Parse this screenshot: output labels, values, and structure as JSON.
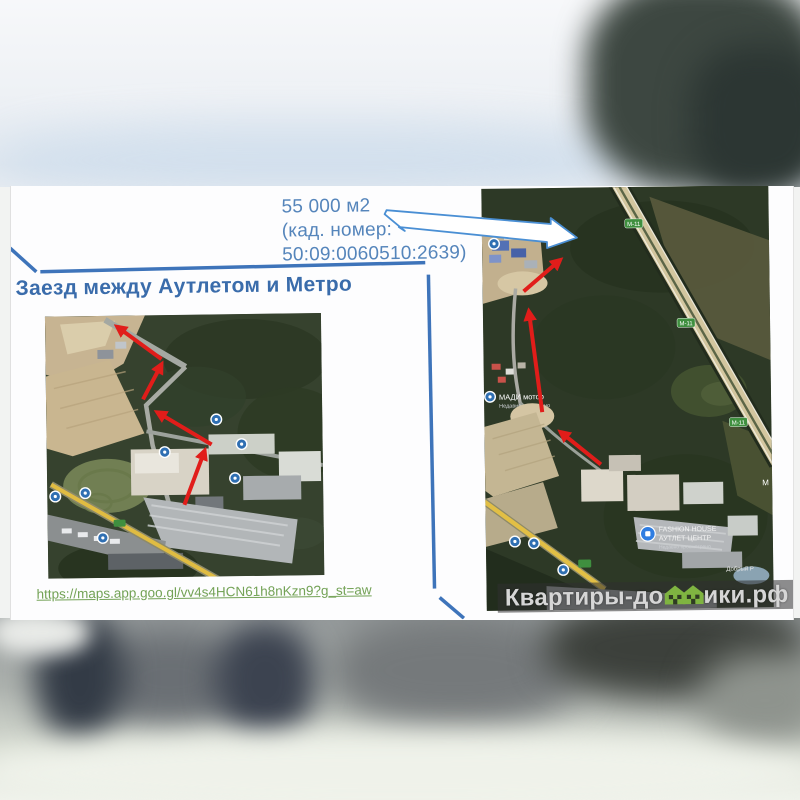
{
  "slide": {
    "annotation": {
      "line1": "55 000 м2",
      "line2": "(кад. номер:",
      "line3": "50:09:0060510:2639)"
    },
    "heading": "Заезд между Аутлетом и Метро",
    "link": "https://maps.app.goo.gl/vv4s4HCN61h8nKzn9?g_st=aw"
  },
  "right_map": {
    "highway_badge": "М-11",
    "madi_label": "МАДИ мотор",
    "madi_sub": "Недавно осмотрено",
    "outlet_line1": "FASHION HOUSE",
    "outlet_line2": "АУТЛЕТ ЦЕНТР",
    "outlet_line3": "Недавно просмотрено",
    "village_label": "Добрый Р",
    "edge_label": "М"
  },
  "watermark": {
    "prefix": "Квартиры-до",
    "suffix": "ики.рф"
  },
  "colors": {
    "heading_blue": "#3a6cab",
    "text_blue": "#5585bb",
    "callout_blue": "#3e74ba",
    "link_green": "#73a256",
    "route_red": "#e11d1a",
    "watermark_green": "#7fb441",
    "highway_badge_green": "#3f8f3f"
  }
}
